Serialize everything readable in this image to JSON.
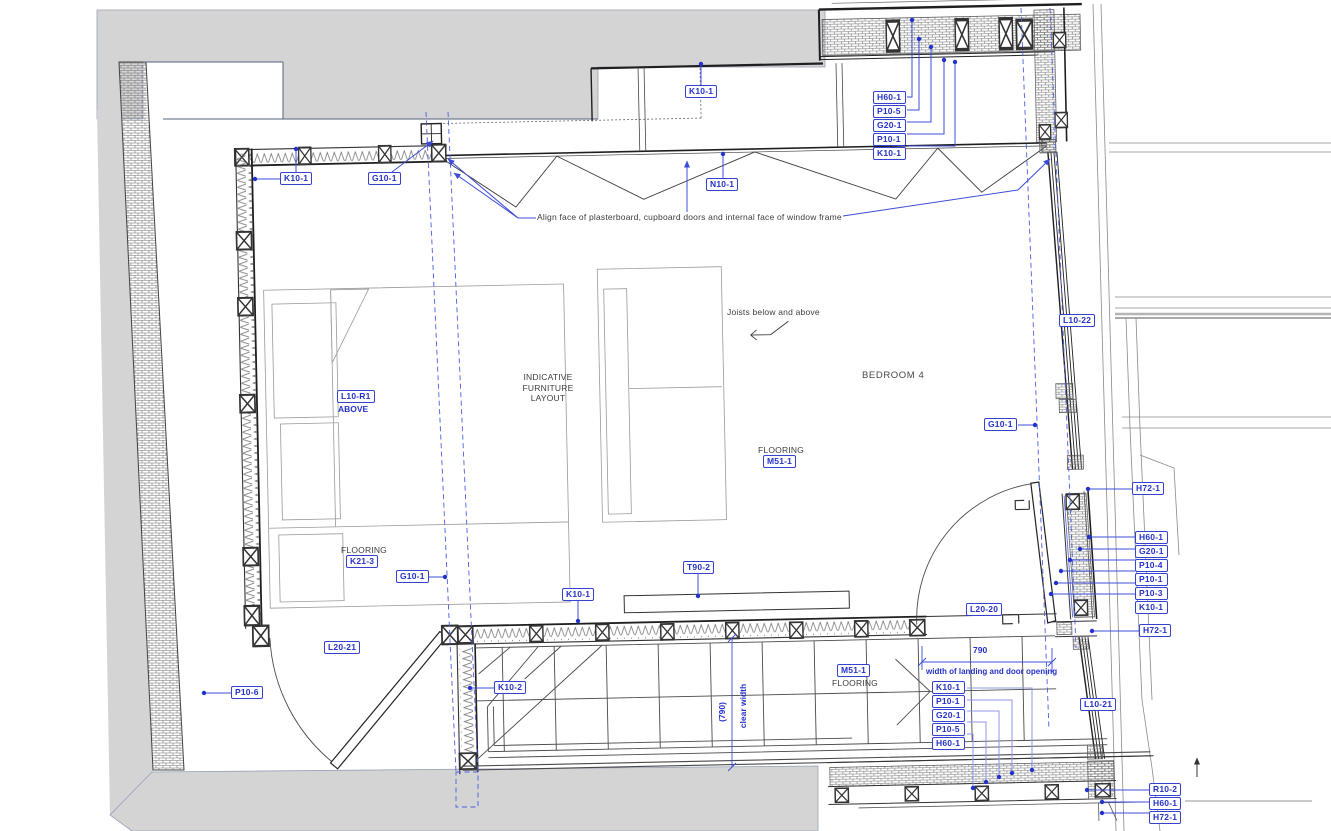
{
  "drawing": {
    "room_name": "BEDROOM 4",
    "texts": {
      "align_note": "Align face of plasterboard, cupboard doors and internal face of window frame",
      "joists_note": "Joists below and above",
      "indicative_1": "INDICATIVE",
      "indicative_2": "FURNITURE",
      "indicative_3": "LAYOUT",
      "flooring": "FLOORING",
      "above": "ABOVE",
      "clear_width_value": "(790)",
      "clear_width_label": "clear width",
      "landing_value": "790",
      "landing_label": "width of landing and door opening"
    },
    "tags": {
      "k10_1_left_wall": "K10-1",
      "g10_1_top": "G10-1",
      "k10_1_cupboard": "K10-1",
      "n10_1": "N10-1",
      "l10_22": "L10-22",
      "g10_1_right": "G10-1",
      "h72_1_upper": "H72-1",
      "h72_1_lower": "H72-1",
      "l10_r1": "L10-R1",
      "m51_1_room": "M51-1",
      "k21_3": "K21-3",
      "g10_1_lower": "G10-1",
      "k10_1_stairs": "K10-1",
      "t90_2": "T90-2",
      "l20_21": "L20-21",
      "p10_6": "P10-6",
      "k10_2": "K10-2",
      "m51_1_stairs": "M51-1",
      "l20_20": "L20-20",
      "l10_21": "L10-21"
    },
    "stacks": {
      "top": [
        "H60-1",
        "P10-5",
        "G20-1",
        "P10-1",
        "K10-1"
      ],
      "right": [
        "H60-1",
        "G20-1",
        "P10-4",
        "P10-1",
        "P10-3",
        "K10-1"
      ],
      "bottom": [
        "K10-1",
        "P10-1",
        "G20-1",
        "P10-5",
        "H60-1"
      ],
      "corner": [
        "R10-2",
        "H60-1",
        "H72-1"
      ]
    },
    "colors": {
      "annotation_blue": "#2531c9",
      "leader_blue": "#3d4cd8",
      "light_leader_blue": "#8c96ea",
      "grid_blue": "#4c5ee0",
      "line_black": "#1f1f1f",
      "context_gray": "#d4d4d4"
    }
  }
}
